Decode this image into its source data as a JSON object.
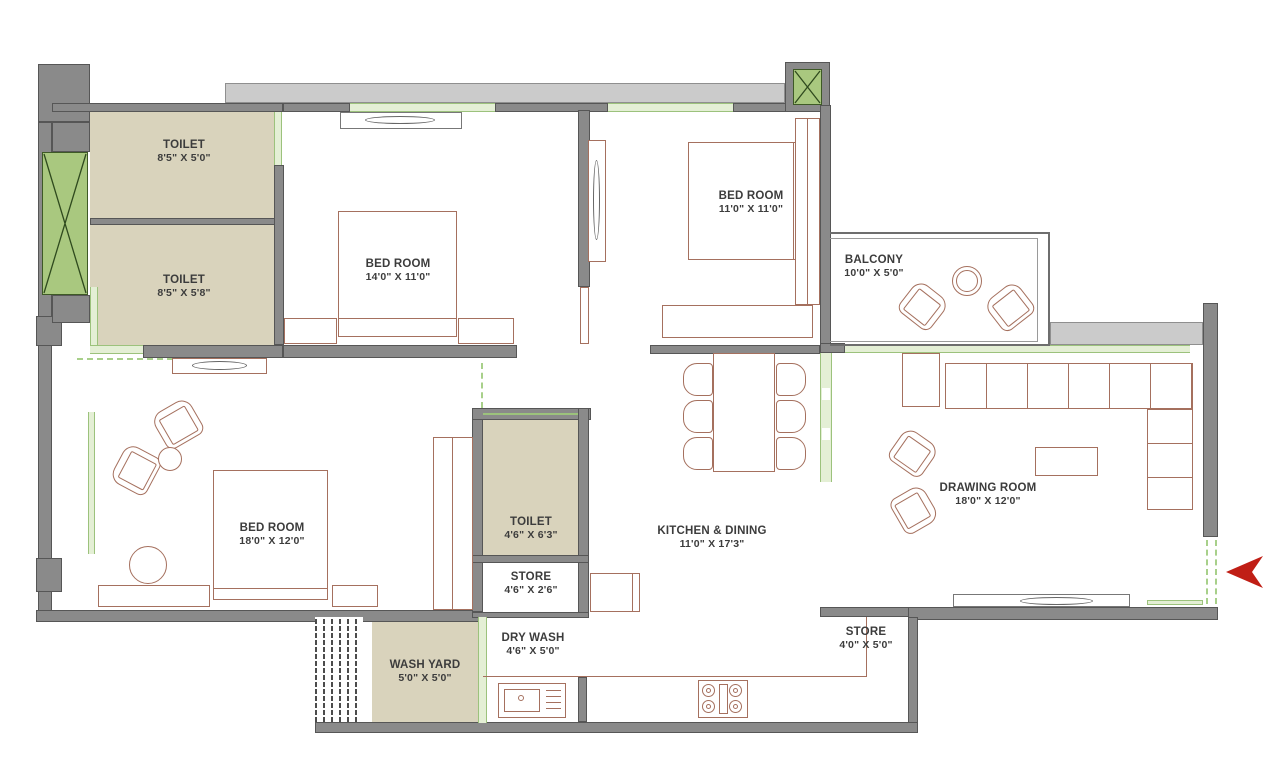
{
  "plan": {
    "title": "3 BHK apartment floor plan",
    "rooms": [
      {
        "name": "TOILET",
        "dims": "8'5\" X 5'0\""
      },
      {
        "name": "TOILET",
        "dims": "8'5\" X 5'8\""
      },
      {
        "name": "BED ROOM",
        "dims": "14'0\" X 11'0\""
      },
      {
        "name": "BED ROOM",
        "dims": "11'0\" X 11'0\""
      },
      {
        "name": "BALCONY",
        "dims": "10'0\" X 5'0\""
      },
      {
        "name": "DRAWING ROOM",
        "dims": "18'0\" X 12'0\""
      },
      {
        "name": "KITCHEN & DINING",
        "dims": "11'0\" X 17'3\""
      },
      {
        "name": "BED ROOM",
        "dims": "18'0\" X 12'0\""
      },
      {
        "name": "TOILET",
        "dims": "4'6\" X 6'3\""
      },
      {
        "name": "STORE",
        "dims": "4'6\" X 2'6\""
      },
      {
        "name": "WASH YARD",
        "dims": "5'0\" X 5'0\""
      },
      {
        "name": "DRY WASH",
        "dims": "4'6\" X 5'0\""
      },
      {
        "name": "STORE",
        "dims": "4'0\" X 5'0\""
      }
    ],
    "symbols": {
      "lift_shaft": "x-cross-box",
      "duct": "x-cross-box",
      "entry_arrow": "left-pointing-arrow"
    },
    "colors": {
      "wall": "#8a8a8a",
      "wall_light": "#cbcbcb",
      "room_beige": "#d9d3bc",
      "shaft_green": "#a9c87f",
      "window_green": "#e4efd5",
      "furniture_line": "#a5705e",
      "text": "#3c3c3c",
      "arrow_red": "#c01e15"
    }
  }
}
